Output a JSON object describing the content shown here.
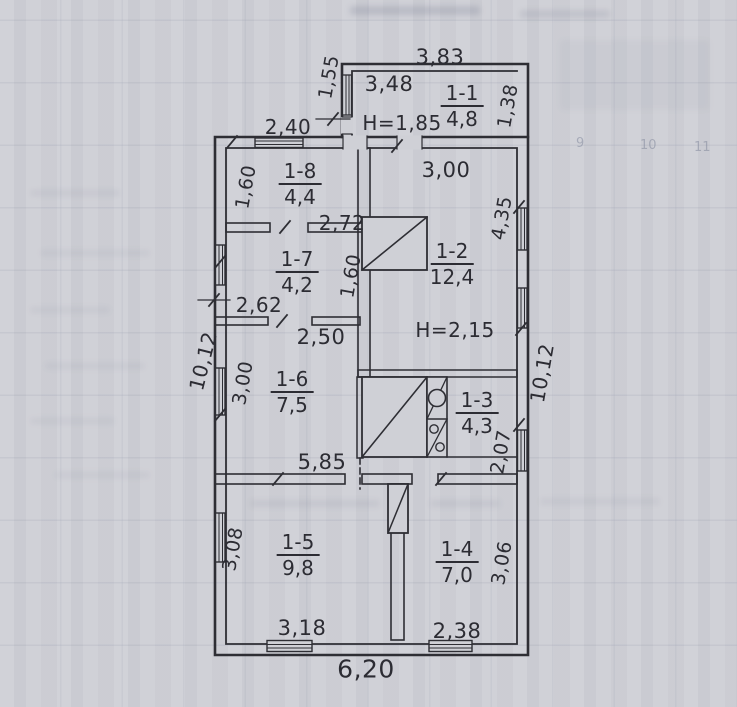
{
  "drawing": "floor-plan",
  "rooms": {
    "r11": {
      "id": "1-1",
      "area": "4,8",
      "height": "H=1,85"
    },
    "r12": {
      "id": "1-2",
      "area": "12,4",
      "height": "H=2,15"
    },
    "r13": {
      "id": "1-3",
      "area": "4,3"
    },
    "r14": {
      "id": "1-4",
      "area": "7,0"
    },
    "r15": {
      "id": "1-5",
      "area": "9,8"
    },
    "r16": {
      "id": "1-6",
      "area": "7,5"
    },
    "r17": {
      "id": "1-7",
      "area": "4,2"
    },
    "r18": {
      "id": "1-8",
      "area": "4,4"
    }
  },
  "dims": {
    "annex_top": "3,83",
    "annex_inner": "3,48",
    "annex_left": "1,55",
    "annex_right": "1,38",
    "top_left": "2,40",
    "r12_top": "3,00",
    "r18_left": "1,60",
    "r18_bottom": "2,72",
    "r17_bottom": "2,62",
    "r17_right": "1,60",
    "r12_right": "4,35",
    "left_total": "10,12",
    "right_total": "10,12",
    "r16_top": "2,50",
    "r16_left": "3,00",
    "mid_width": "5,85",
    "r13_right": "2,07",
    "r15_left": "3,08",
    "r14_right": "3,06",
    "r15_bottom": "3,18",
    "r14_bottom": "2,38",
    "bottom_total": "6,20"
  },
  "background": {
    "bleed_numbers": [
      "9",
      "10",
      "11"
    ]
  },
  "colors": {
    "ink": "#2c2c33",
    "paper": "#cfd0d6"
  }
}
